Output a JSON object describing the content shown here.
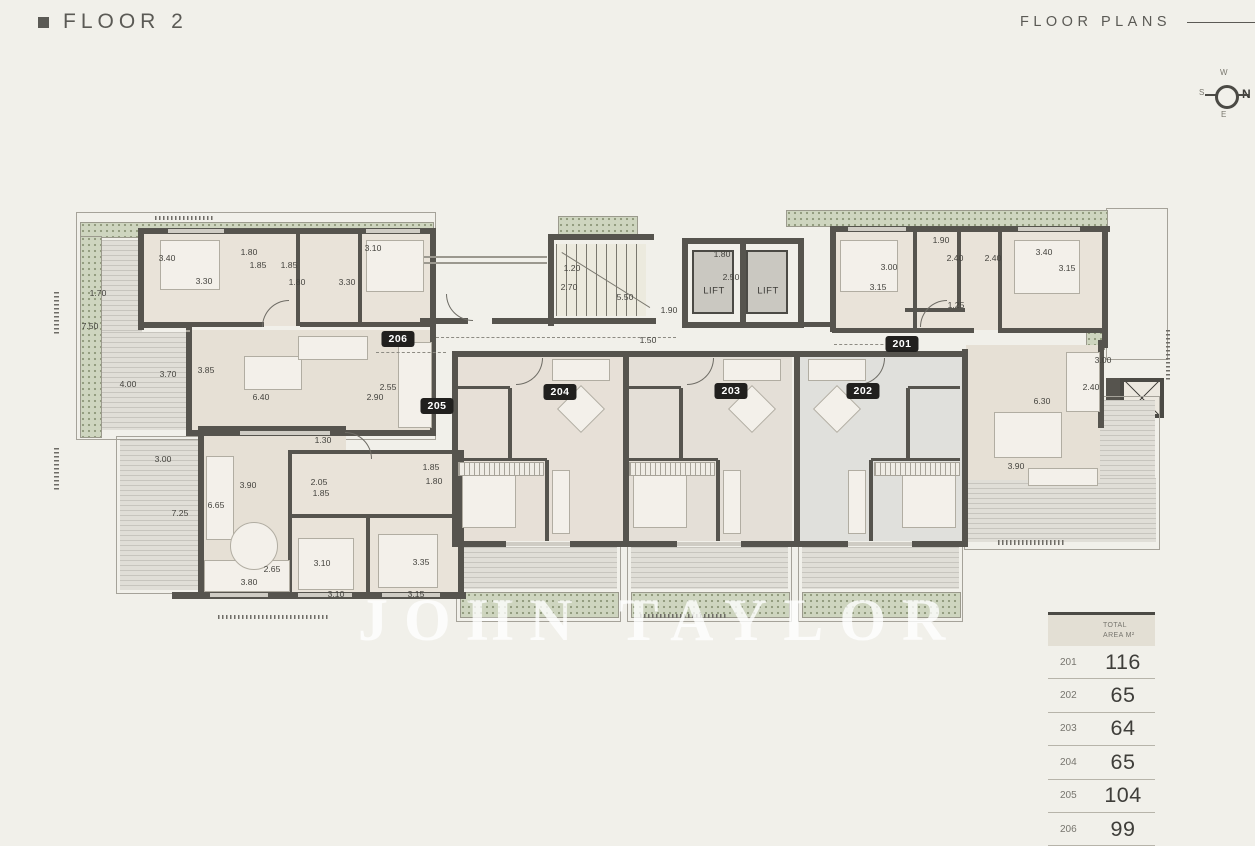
{
  "header": {
    "title": "FLOOR 2",
    "section": "FLOOR PLANS"
  },
  "compass": {
    "n": "N",
    "e": "E",
    "s": "S",
    "w": "W"
  },
  "watermark": "JOHN TAYLOR",
  "plan": {
    "lifts": [
      {
        "label": "LIFT",
        "x": 714,
        "y": 291
      },
      {
        "label": "LIFT",
        "x": 768,
        "y": 291
      }
    ],
    "unit_badges": [
      {
        "id": "206",
        "x": 398,
        "y": 339
      },
      {
        "id": "205",
        "x": 437,
        "y": 406
      },
      {
        "id": "204",
        "x": 560,
        "y": 392
      },
      {
        "id": "203",
        "x": 731,
        "y": 391
      },
      {
        "id": "202",
        "x": 863,
        "y": 391
      },
      {
        "id": "201",
        "x": 902,
        "y": 344
      }
    ],
    "dimensions": [
      {
        "t": "3.40",
        "x": 167,
        "y": 258
      },
      {
        "t": "1.80",
        "x": 249,
        "y": 252
      },
      {
        "t": "1.85",
        "x": 258,
        "y": 265
      },
      {
        "t": "1.85",
        "x": 289,
        "y": 265
      },
      {
        "t": "3.30",
        "x": 204,
        "y": 281
      },
      {
        "t": "1.80",
        "x": 297,
        "y": 282
      },
      {
        "t": "3.30",
        "x": 347,
        "y": 282
      },
      {
        "t": "3.10",
        "x": 373,
        "y": 248
      },
      {
        "t": "1.70",
        "x": 98,
        "y": 293
      },
      {
        "t": "7.50",
        "x": 90,
        "y": 326
      },
      {
        "t": "4.00",
        "x": 128,
        "y": 384
      },
      {
        "t": "3.70",
        "x": 168,
        "y": 374
      },
      {
        "t": "3.85",
        "x": 206,
        "y": 370
      },
      {
        "t": "6.40",
        "x": 261,
        "y": 397
      },
      {
        "t": "2.55",
        "x": 388,
        "y": 387
      },
      {
        "t": "2.90",
        "x": 375,
        "y": 397
      },
      {
        "t": "1.20",
        "x": 572,
        "y": 268
      },
      {
        "t": "2.70",
        "x": 569,
        "y": 287
      },
      {
        "t": "5.50",
        "x": 625,
        "y": 297
      },
      {
        "t": "1.90",
        "x": 669,
        "y": 310
      },
      {
        "t": "1.80",
        "x": 722,
        "y": 254
      },
      {
        "t": "2.50",
        "x": 731,
        "y": 277
      },
      {
        "t": "1.50",
        "x": 648,
        "y": 340
      },
      {
        "t": "1.90",
        "x": 941,
        "y": 240
      },
      {
        "t": "3.00",
        "x": 889,
        "y": 267
      },
      {
        "t": "2.40",
        "x": 955,
        "y": 258
      },
      {
        "t": "2.40",
        "x": 993,
        "y": 258
      },
      {
        "t": "3.40",
        "x": 1044,
        "y": 252
      },
      {
        "t": "3.15",
        "x": 1067,
        "y": 268
      },
      {
        "t": "3.15",
        "x": 878,
        "y": 287
      },
      {
        "t": "1.25",
        "x": 956,
        "y": 305
      },
      {
        "t": "3.00",
        "x": 1103,
        "y": 360
      },
      {
        "t": "2.40",
        "x": 1091,
        "y": 387
      },
      {
        "t": "6.30",
        "x": 1042,
        "y": 401
      },
      {
        "t": "3.90",
        "x": 1016,
        "y": 466
      },
      {
        "t": "1.30",
        "x": 323,
        "y": 440
      },
      {
        "t": "3.00",
        "x": 163,
        "y": 459
      },
      {
        "t": "3.90",
        "x": 248,
        "y": 485
      },
      {
        "t": "6.65",
        "x": 216,
        "y": 505
      },
      {
        "t": "7.25",
        "x": 180,
        "y": 513
      },
      {
        "t": "2.05",
        "x": 319,
        "y": 482
      },
      {
        "t": "1.85",
        "x": 321,
        "y": 493
      },
      {
        "t": "1.85",
        "x": 431,
        "y": 467
      },
      {
        "t": "1.80",
        "x": 434,
        "y": 481
      },
      {
        "t": "3.10",
        "x": 322,
        "y": 563
      },
      {
        "t": "3.35",
        "x": 421,
        "y": 562
      },
      {
        "t": "2.65",
        "x": 272,
        "y": 569
      },
      {
        "t": "3.80",
        "x": 249,
        "y": 582
      },
      {
        "t": "3.10",
        "x": 336,
        "y": 594
      },
      {
        "t": "3.15",
        "x": 416,
        "y": 594
      }
    ]
  },
  "area_table": {
    "header": "TOTAL AREA M²",
    "rows": [
      {
        "unit": "201",
        "area": "116"
      },
      {
        "unit": "202",
        "area": "65"
      },
      {
        "unit": "203",
        "area": "64"
      },
      {
        "unit": "204",
        "area": "65"
      },
      {
        "unit": "205",
        "area": "104"
      },
      {
        "unit": "206",
        "area": "99"
      }
    ]
  }
}
